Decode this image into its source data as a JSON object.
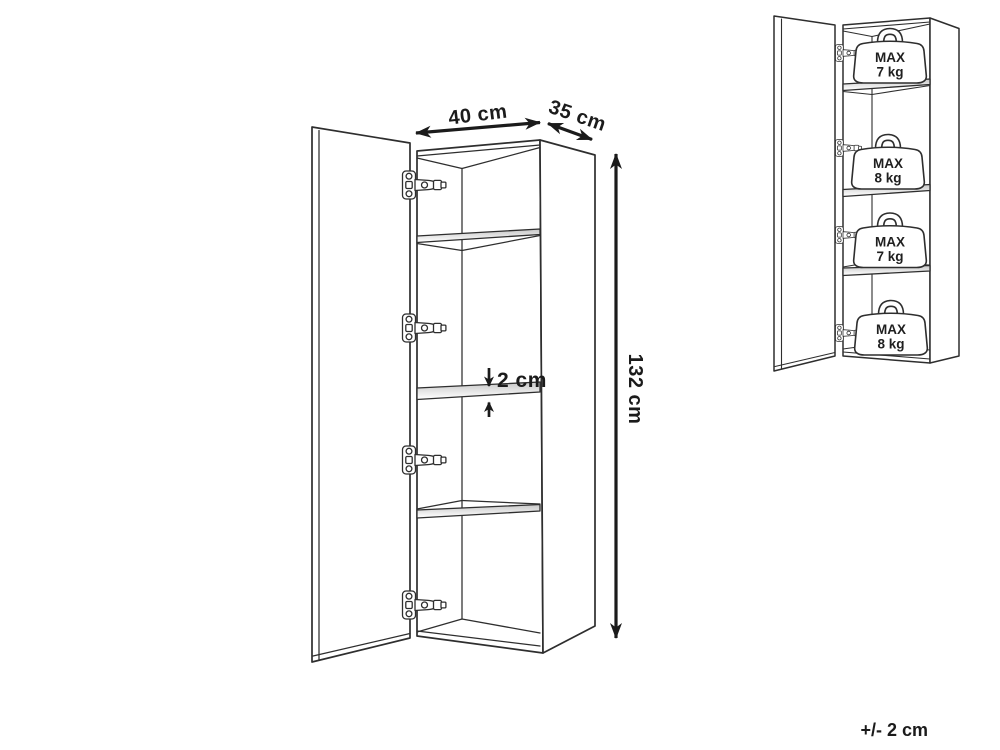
{
  "colors": {
    "background": "#ffffff",
    "line": "#2e2e2e",
    "dim": "#1b1b1b",
    "shelf_shade": "#c7c7c7"
  },
  "main_cabinet": {
    "width_label": "40 cm",
    "depth_label": "35 cm",
    "height_label": "132 cm",
    "shelf_thickness_label": "2 cm"
  },
  "load_cabinet": {
    "shelf_limits": [
      {
        "prefix": "MAX",
        "value": "7 kg"
      },
      {
        "prefix": "MAX",
        "value": "8 kg"
      },
      {
        "prefix": "MAX",
        "value": "7 kg"
      },
      {
        "prefix": "MAX",
        "value": "8 kg"
      }
    ]
  },
  "footer": {
    "tolerance": "+/- 2 cm"
  }
}
